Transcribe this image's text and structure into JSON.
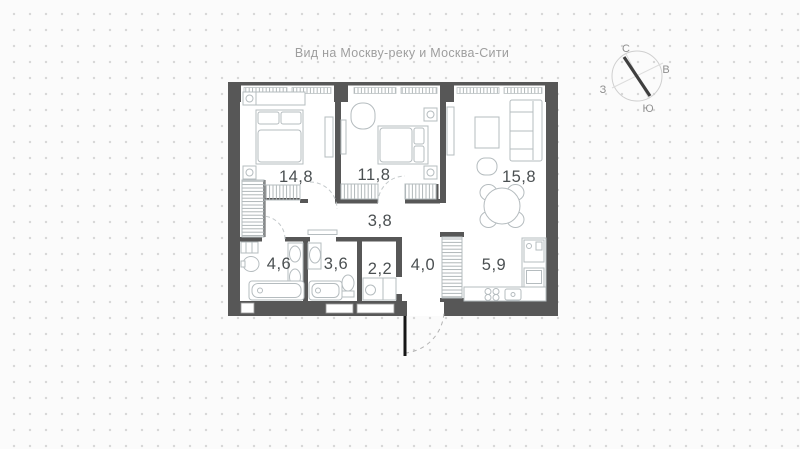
{
  "caption": "Вид на Москву-реку и Москва-Сити",
  "compass": {
    "north": "С",
    "east": "В",
    "west": "З",
    "south": "Ю"
  },
  "rooms": {
    "bedroom1": {
      "name": "bedroom-1",
      "area": "14,8"
    },
    "bedroom2": {
      "name": "bedroom-2",
      "area": "11,8"
    },
    "living": {
      "name": "living-room",
      "area": "15,8"
    },
    "corridor": {
      "name": "corridor",
      "area": "3,8"
    },
    "bathroom1": {
      "name": "bathroom-1",
      "area": "4,6"
    },
    "bathroom2": {
      "name": "bathroom-2",
      "area": "3,6"
    },
    "wc": {
      "name": "wc",
      "area": "2,2"
    },
    "hall": {
      "name": "hallway",
      "area": "4,0"
    },
    "kitchen": {
      "name": "kitchen",
      "area": "5,9"
    }
  },
  "colors": {
    "wall": "#575757",
    "furniture": "#b5bcbf",
    "accentDoor": "#161616",
    "dots": "#d7d7d7"
  }
}
